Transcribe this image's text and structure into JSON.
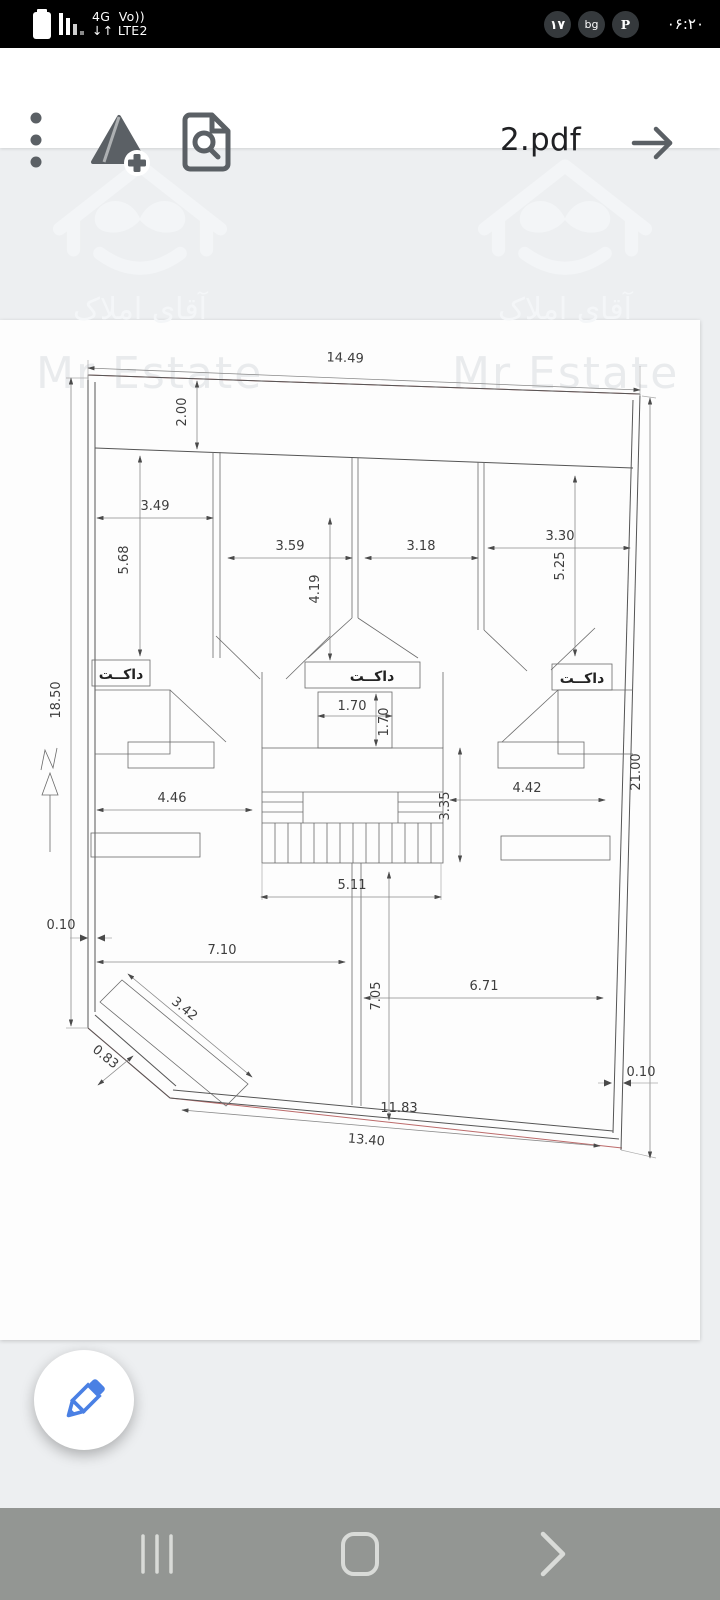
{
  "status_bar": {
    "network_line1": "4G  Vo))",
    "network_line2": "↓↑ LTE2",
    "badges": [
      "۱۷",
      "bg",
      "P"
    ],
    "time": "۰۶:۲۰"
  },
  "toolbar": {
    "title": "2.pdf"
  },
  "watermark": {
    "fa": "آقای املاک",
    "en": "Mr Estate"
  },
  "plan": {
    "duct_label": "داکــت",
    "dimensions": [
      {
        "v": "14.49",
        "x": 345,
        "y": 362,
        "r": 2
      },
      {
        "v": "2.00",
        "x": 186,
        "y": 412,
        "r": -90
      },
      {
        "v": "18.50",
        "x": 60,
        "y": 700,
        "r": -90
      },
      {
        "v": "21.00",
        "x": 640,
        "y": 772,
        "r": -90
      },
      {
        "v": "3.49",
        "x": 155,
        "y": 510,
        "r": 0
      },
      {
        "v": "5.68",
        "x": 128,
        "y": 560,
        "r": -90
      },
      {
        "v": "3.59",
        "x": 290,
        "y": 550,
        "r": 0
      },
      {
        "v": "4.19",
        "x": 319,
        "y": 589,
        "r": -90
      },
      {
        "v": "3.18",
        "x": 421,
        "y": 550,
        "r": 0
      },
      {
        "v": "3.30",
        "x": 560,
        "y": 540,
        "r": 0
      },
      {
        "v": "5.25",
        "x": 564,
        "y": 566,
        "r": -90
      },
      {
        "v": "1.70",
        "x": 352,
        "y": 710,
        "r": 0
      },
      {
        "v": "1.70",
        "x": 388,
        "y": 722,
        "r": -90
      },
      {
        "v": "4.46",
        "x": 172,
        "y": 802,
        "r": 0
      },
      {
        "v": "4.42",
        "x": 527,
        "y": 792,
        "r": 0
      },
      {
        "v": "3.35",
        "x": 449,
        "y": 806,
        "r": -90
      },
      {
        "v": "5.11",
        "x": 352,
        "y": 889,
        "r": 0
      },
      {
        "v": "7.10",
        "x": 222,
        "y": 954,
        "r": 0
      },
      {
        "v": "7.05",
        "x": 380,
        "y": 996,
        "r": -90
      },
      {
        "v": "6.71",
        "x": 484,
        "y": 990,
        "r": 0
      },
      {
        "v": "0.10",
        "x": 61,
        "y": 929,
        "r": 0
      },
      {
        "v": "0.10",
        "x": 641,
        "y": 1076,
        "r": 0
      },
      {
        "v": "3.42",
        "x": 182,
        "y": 1012,
        "r": 39
      },
      {
        "v": "0.83",
        "x": 103,
        "y": 1060,
        "r": 39
      },
      {
        "v": "11.83",
        "x": 399,
        "y": 1112,
        "r": 0
      },
      {
        "v": "13.40",
        "x": 366,
        "y": 1144,
        "r": 5
      }
    ]
  },
  "colors": {
    "accent_blue": "#4a80e4",
    "toolbar_icon": "#5b6065",
    "nav_bg": "#939693",
    "status_badge_bg": "#35393c"
  }
}
